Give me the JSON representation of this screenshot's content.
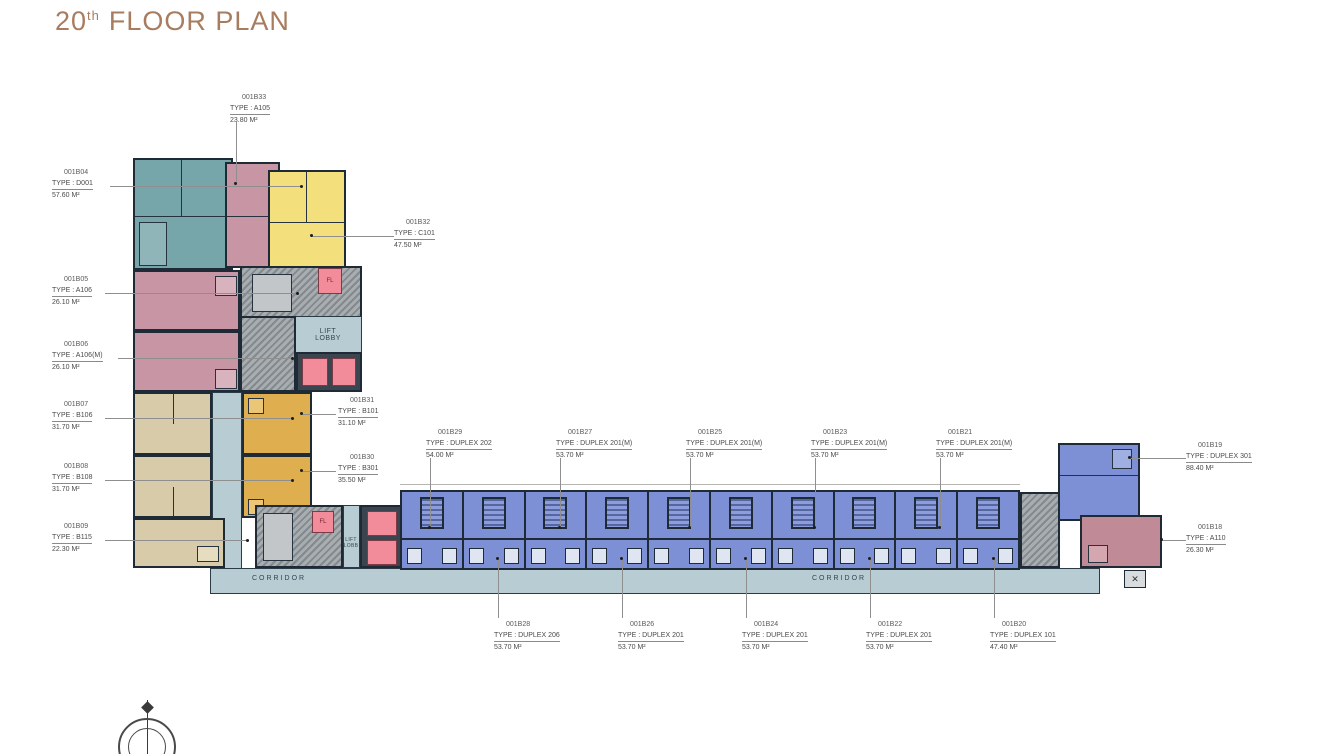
{
  "title": {
    "number": "20",
    "sup": "th",
    "rest": "FLOOR PLAN"
  },
  "colors": {
    "title_brown": "#A87C5F",
    "teal_unit": "#76A6AA",
    "pink_unit": "#C795A3",
    "yellow_unit": "#F3DF7C",
    "gold_unit": "#DFAE4E",
    "tan_unit": "#D8CBA9",
    "blue_unit": "#7D90D6",
    "corridor": "#B7CDD3",
    "lift_pink": "#F28C9B",
    "wall": "#1E2A36",
    "core_gray": "#A8ADAF"
  },
  "plan": {
    "texts": {
      "lift_lobby_line1": "LIFT",
      "lift_lobby_line2": "LOBBY",
      "lift_lobb_line1": "LIFT",
      "lift_lobb_line2": "LOBB",
      "corridor_left": "CORRIDOR",
      "corridor_right": "CORRIDOR",
      "fire_lift": "FL"
    },
    "wing_units": [
      "001B29",
      "001B28",
      "001B27",
      "001B26",
      "001B25",
      "001B24",
      "001B23",
      "001B22",
      "001B21",
      "001B20"
    ],
    "labels": [
      {
        "unit": "001B04",
        "type": "TYPE : D001",
        "area": "57.60 M²"
      },
      {
        "unit": "001B05",
        "type": "TYPE : A106",
        "area": "26.10 M²"
      },
      {
        "unit": "001B06",
        "type": "TYPE : A106(M)",
        "area": "26.10 M²"
      },
      {
        "unit": "001B07",
        "type": "TYPE : B106",
        "area": "31.70 M²"
      },
      {
        "unit": "001B08",
        "type": "TYPE : B108",
        "area": "31.70 M²"
      },
      {
        "unit": "001B09",
        "type": "TYPE : B115",
        "area": "22.30 M²"
      },
      {
        "unit": "001B33",
        "type": "TYPE : A105",
        "area": "23.80 M²"
      },
      {
        "unit": "001B32",
        "type": "TYPE : C101",
        "area": "47.50 M²"
      },
      {
        "unit": "001B31",
        "type": "TYPE : B101",
        "area": "31.10 M²"
      },
      {
        "unit": "001B30",
        "type": "TYPE : B301",
        "area": "35.50 M²"
      },
      {
        "unit": "001B29",
        "type": "TYPE : DUPLEX 202",
        "area": "54.00 M²"
      },
      {
        "unit": "001B27",
        "type": "TYPE : DUPLEX 201(M)",
        "area": "53.70 M²"
      },
      {
        "unit": "001B25",
        "type": "TYPE : DUPLEX 201(M)",
        "area": "53.70 M²"
      },
      {
        "unit": "001B23",
        "type": "TYPE : DUPLEX 201(M)",
        "area": "53.70 M²"
      },
      {
        "unit": "001B21",
        "type": "TYPE : DUPLEX 201(M)",
        "area": "53.70 M²"
      },
      {
        "unit": "001B28",
        "type": "TYPE : DUPLEX 206",
        "area": "53.70 M²"
      },
      {
        "unit": "001B26",
        "type": "TYPE : DUPLEX 201",
        "area": "53.70 M²"
      },
      {
        "unit": "001B24",
        "type": "TYPE : DUPLEX 201",
        "area": "53.70 M²"
      },
      {
        "unit": "001B22",
        "type": "TYPE : DUPLEX 201",
        "area": "53.70 M²"
      },
      {
        "unit": "001B20",
        "type": "TYPE : DUPLEX 101",
        "area": "47.40 M²"
      },
      {
        "unit": "001B19",
        "type": "TYPE : DUPLEX 301",
        "area": "88.40 M²"
      },
      {
        "unit": "001B18",
        "type": "TYPE : A110",
        "area": "26.30 M²"
      }
    ]
  }
}
